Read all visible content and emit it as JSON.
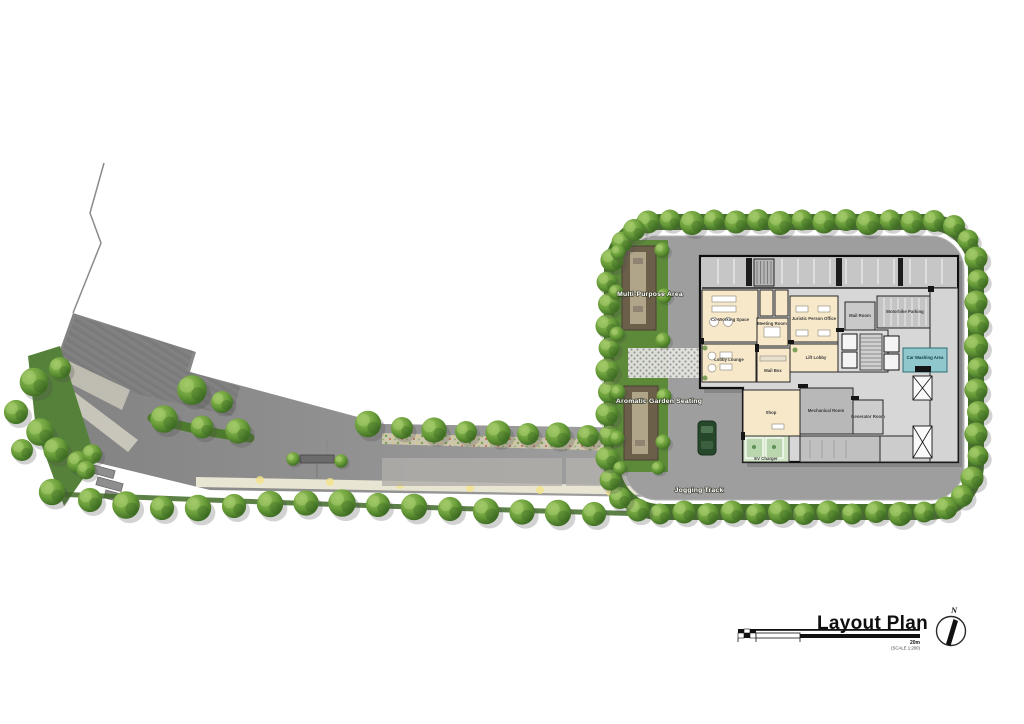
{
  "title_block": {
    "title": "Layout Plan",
    "scale_bar": {
      "end_label": "20m",
      "scale_note": "(SCALE 1:200)"
    },
    "compass": {
      "north_label": "N"
    }
  },
  "site_labels": {
    "multi_purpose_area": "Multi-Purpose Area",
    "aromatic_garden_seating": "Aromatic Garden Seating",
    "jogging_track": "Jogging Track"
  },
  "building_rooms": {
    "co_working_space": "Co-Working Space",
    "meeting_room": "Meeting Room",
    "juristic_person_office": "Juristic Person Office",
    "lobby_lounge": "Lobby Lounge",
    "mail_box": "Mail Box",
    "lift_lobby": "Lift Lobby",
    "shop": "Shop",
    "mechanical_room": "Mechanical Room",
    "generator_room": "Generator Room",
    "mail_room": "Mail Room",
    "motorbike_parking": "Motorbike Parking",
    "car_washing_area": "Car Washing Area",
    "ev_charger": "EV Charger"
  },
  "colors": {
    "background": "#ffffff",
    "tree_green": "#5d8f3a",
    "hedge_green": "#46722a",
    "road_gray": "#9e9e9e",
    "plaza_gray": "#7d7d7d",
    "room_cream": "#f6e8c9",
    "building_gray": "#c6c6c6",
    "car_washing_teal": "#8fc7cc",
    "ev_charger_green": "#d2e5c6",
    "jogging_track_beige": "#e9e5d3"
  }
}
